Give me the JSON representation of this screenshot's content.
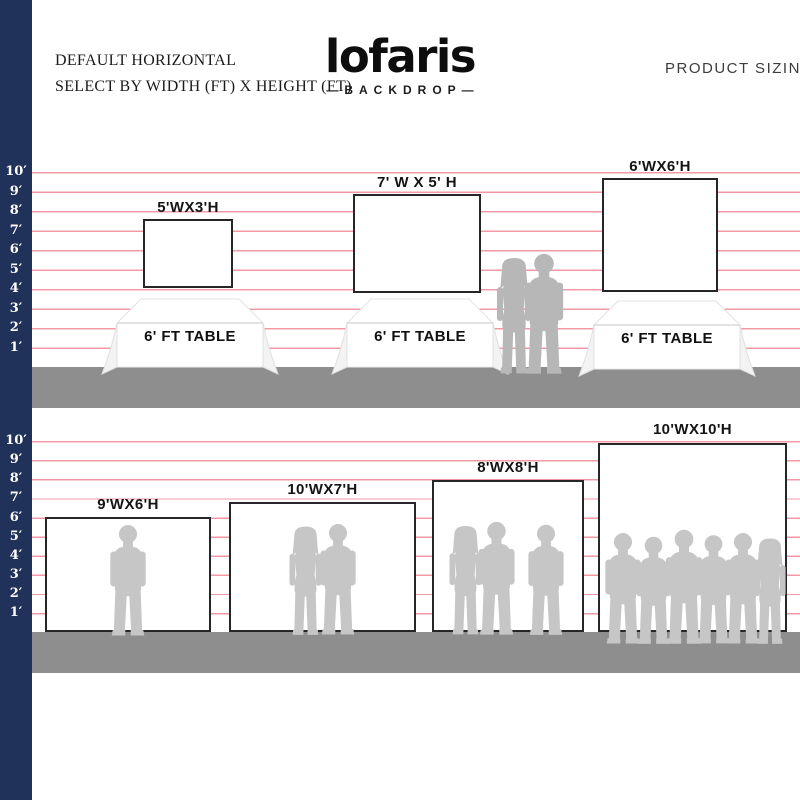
{
  "header": {
    "left_line1": "DEFAULT HORIZONTAL",
    "left_line2": "SELECT BY WIDTH (FT) X HEIGHT (FT)",
    "logo": "lofaris",
    "logo_sub": "—BACKDROP—",
    "right": "PRODUCT SIZING"
  },
  "scale": {
    "unit": "ft",
    "labels": [
      "10′",
      "9′",
      "8′",
      "7′",
      "6′",
      "5′",
      "4′",
      "3′",
      "2′",
      "1′"
    ]
  },
  "top_section": {
    "table_label": "6' FT TABLE",
    "backdrops": [
      {
        "label": "5'WX3'H",
        "width_ft": 5,
        "height_ft": 3
      },
      {
        "label": "7' W X 5' H",
        "width_ft": 7,
        "height_ft": 5
      },
      {
        "label": "6'WX6'H",
        "width_ft": 6,
        "height_ft": 6
      }
    ]
  },
  "bottom_section": {
    "backdrops": [
      {
        "label": "9'WX6'H",
        "width_ft": 9,
        "height_ft": 6
      },
      {
        "label": "10'WX7'H",
        "width_ft": 10,
        "height_ft": 7
      },
      {
        "label": "8'WX8'H",
        "width_ft": 8,
        "height_ft": 8
      },
      {
        "label": "10'WX10'H",
        "width_ft": 10,
        "height_ft": 10
      }
    ]
  },
  "colors": {
    "navy": "#20315a",
    "ruler_line": "#f19aa6",
    "ground": "#8e8e8e",
    "silhouette": "#c6c6c6",
    "silhouette_dark": "#b7b7b7",
    "backdrop_border": "#262626"
  }
}
